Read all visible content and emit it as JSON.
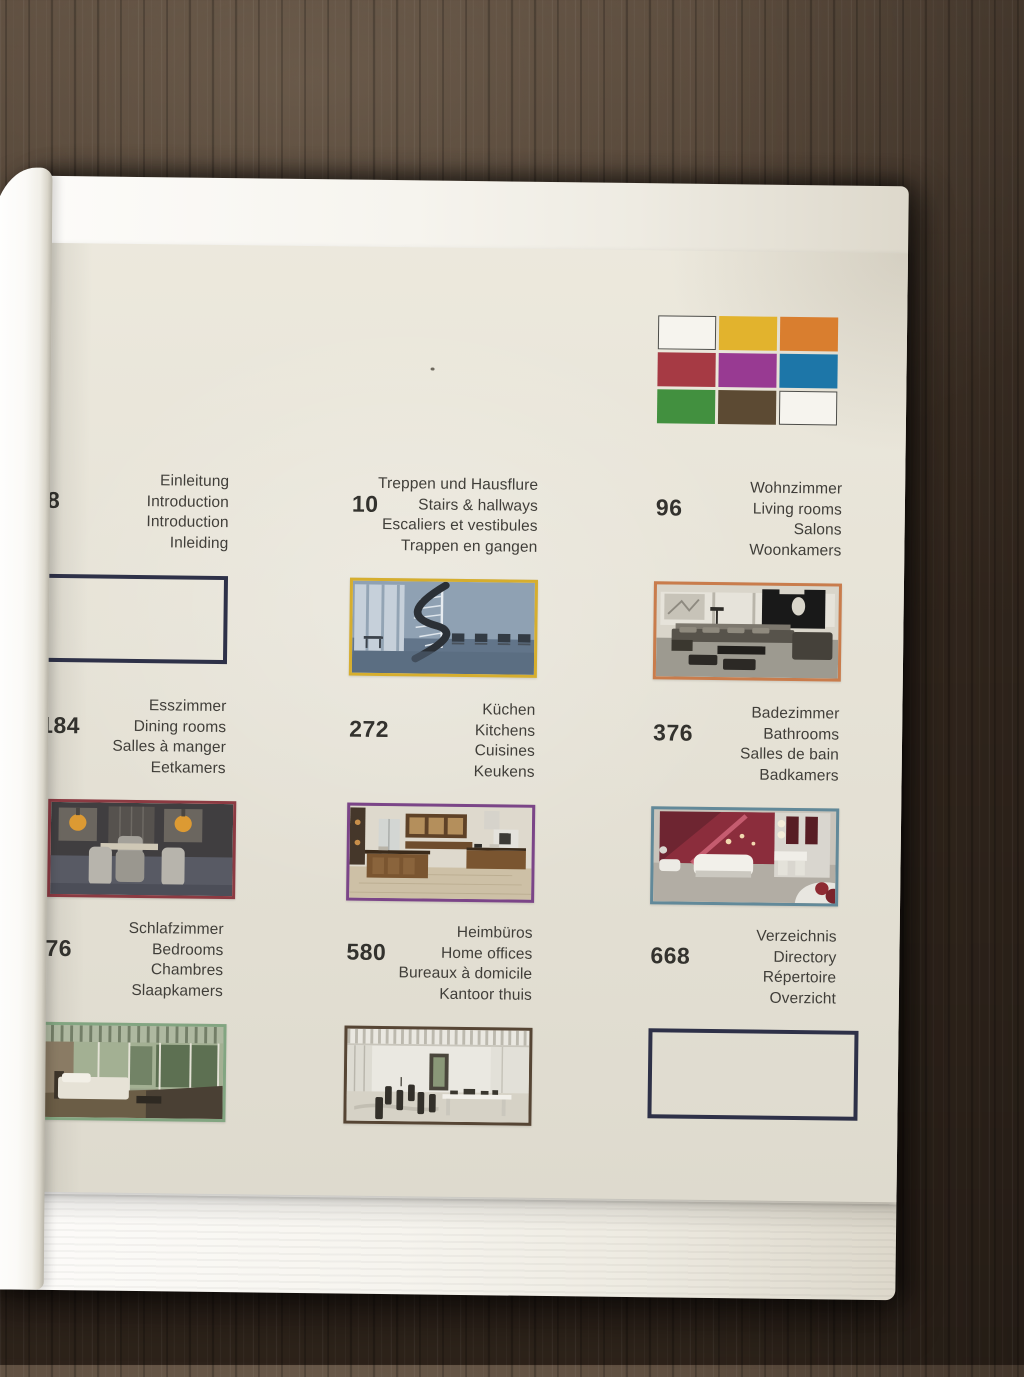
{
  "colors": {
    "page": "#eae6d9",
    "underpages": "#f9f8f4",
    "wood_table": "#3c2e23",
    "empty_box_border": "#2e3148"
  },
  "swatches": {
    "colors": [
      "#f6f4ee",
      "#e2b32d",
      "#d97e2f",
      "#a63a44",
      "#983a92",
      "#1d76a8",
      "#42903f",
      "#5c4a33",
      "#f6f4ee"
    ]
  },
  "entries": [
    {
      "number": "8",
      "lines": [
        "Einleitung",
        "Introduction",
        "Introduction",
        "Inleiding"
      ],
      "accent": "#2e3148",
      "thumb": "empty"
    },
    {
      "number": "10",
      "lines": [
        "Treppen und Hausflure",
        "Stairs & hallways",
        "Escaliers et vestibules",
        "Trappen en gangen"
      ],
      "accent": "#d6ae2e",
      "thumb": "stairs"
    },
    {
      "number": "96",
      "lines": [
        "Wohnzimmer",
        "Living rooms",
        "Salons",
        "Woonkamers"
      ],
      "accent": "#c97c4c",
      "thumb": "living"
    },
    {
      "number": "184",
      "lines": [
        "Esszimmer",
        "Dining rooms",
        "Salles à manger",
        "Eetkamers"
      ],
      "accent": "#8c3a42",
      "thumb": "dining"
    },
    {
      "number": "272",
      "lines": [
        "Küchen",
        "Kitchens",
        "Cuisines",
        "Keukens"
      ],
      "accent": "#7b4588",
      "thumb": "kitchen"
    },
    {
      "number": "376",
      "lines": [
        "Badezimmer",
        "Bathrooms",
        "Salles de bain",
        "Badkamers"
      ],
      "accent": "#628999",
      "thumb": "bathroom"
    },
    {
      "number": "76",
      "lines": [
        "Schlafzimmer",
        "Bedrooms",
        "Chambres",
        "Slaapkamers"
      ],
      "accent": "#82a581",
      "thumb": "bedroom"
    },
    {
      "number": "580",
      "lines": [
        "Heimbüros",
        "Home offices",
        "Bureaux à domicile",
        "Kantoor thuis"
      ],
      "accent": "#564534",
      "thumb": "office"
    },
    {
      "number": "668",
      "lines": [
        "Verzeichnis",
        "Directory",
        "Répertoire",
        "Overzicht"
      ],
      "accent": "#2e3148",
      "thumb": "empty"
    }
  ]
}
